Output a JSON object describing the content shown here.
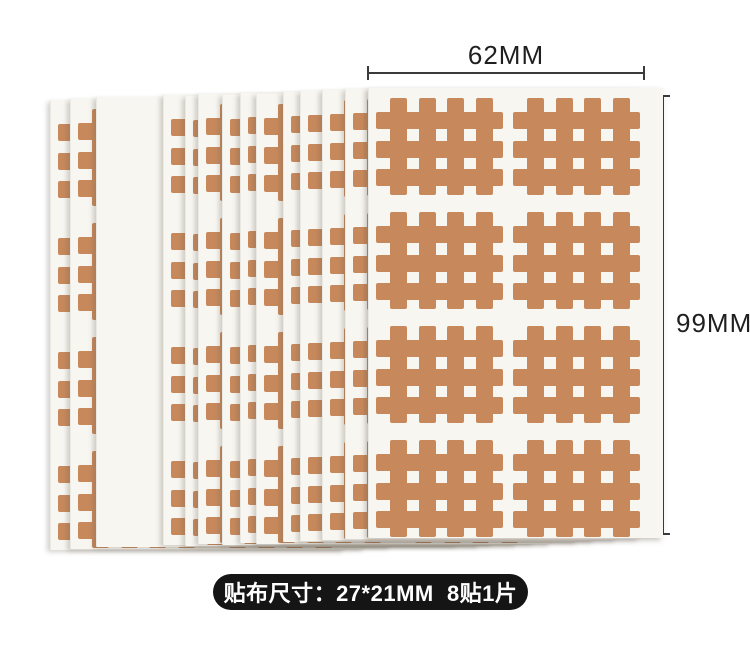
{
  "annotations": {
    "width_label": "62MM",
    "height_label": "99MM",
    "footer_label": "贴布尺寸：27*21MM  8贴1片"
  },
  "colors": {
    "page_background": "#ffffff",
    "patch_tan": "#c7895c",
    "sheet_white": "#f8f6f1",
    "measure_line": "#3b3b3b",
    "badge_background": "#151515",
    "badge_text": "#ffffff"
  },
  "product": {
    "description": "stack of cross-tape sheets, 8 grid patches per sheet",
    "sheet_width": 294,
    "sheet_height": 450,
    "sheets": [
      {
        "left": 50,
        "top": 100
      },
      {
        "left": 70,
        "top": 99
      },
      {
        "left": 96,
        "top": 97,
        "plain": true
      },
      {
        "left": 163,
        "top": 95
      },
      {
        "left": 185,
        "top": 96
      },
      {
        "left": 198,
        "top": 94
      },
      {
        "left": 222,
        "top": 95
      },
      {
        "left": 240,
        "top": 93
      },
      {
        "left": 256,
        "top": 94
      },
      {
        "left": 283,
        "top": 92
      },
      {
        "left": 300,
        "top": 91
      },
      {
        "left": 322,
        "top": 90
      },
      {
        "left": 345,
        "top": 89
      },
      {
        "left": 368,
        "top": 88,
        "front": true
      }
    ],
    "grid": {
      "rows": 4,
      "cols": 2,
      "row_tops": [
        10,
        124,
        238,
        352
      ],
      "col_lefts": [
        7,
        144
      ],
      "patch_width": 127,
      "patch_height": 97
    },
    "patch_shape": {
      "vbar_lefts_pct": [
        11,
        33.5,
        56,
        78.5
      ],
      "vbar_width_pct": 13.4,
      "hbar_tops_pct": [
        14.5,
        44,
        73.5
      ],
      "hbar_height_pct": 17.5
    },
    "measure": {
      "h_line": {
        "left": 368,
        "top": 72,
        "width": 276,
        "height": 2
      },
      "h_tick_left": {
        "left": 367,
        "top": 66,
        "width": 2,
        "height": 14
      },
      "h_tick_right": {
        "left": 643,
        "top": 66,
        "width": 2,
        "height": 14
      },
      "v_line": {
        "left": 662,
        "top": 96,
        "width": 2,
        "height": 438
      },
      "v_tick_top": {
        "left": 656,
        "top": 95,
        "width": 14,
        "height": 2
      },
      "v_tick_bottom": {
        "left": 656,
        "top": 533,
        "width": 14,
        "height": 2
      }
    }
  }
}
